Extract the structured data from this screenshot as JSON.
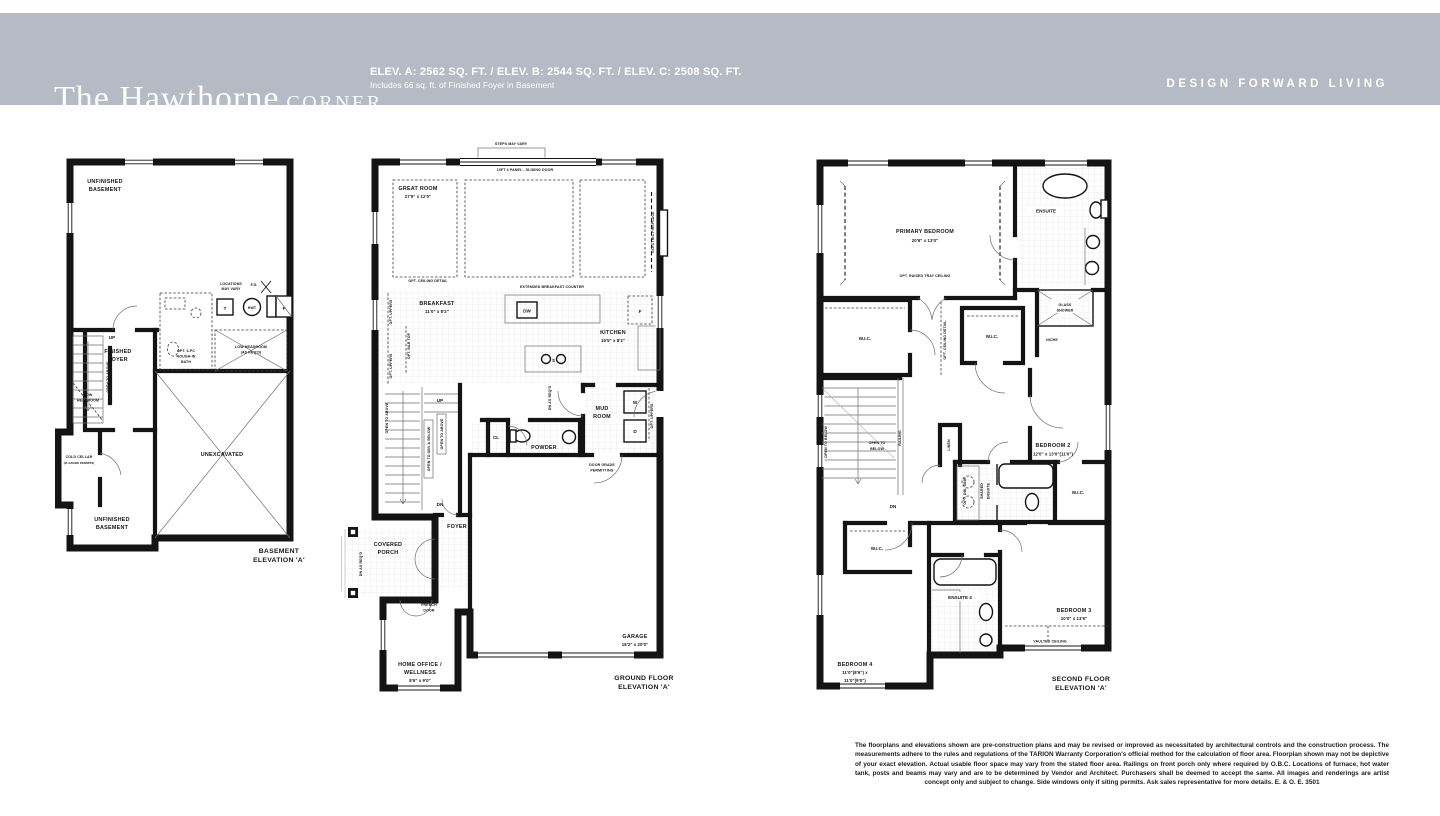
{
  "header": {
    "title": "The Hawthorne",
    "title_suffix": "CORNER",
    "elevations": "ELEV. A: 2562 SQ. FT. / ELEV. B: 2544 SQ. FT. / ELEV. C: 2508 SQ. FT.",
    "includes": "Includes 66 sq. ft. of Finished Foyer in Basement",
    "brand": "DESIGN FORWARD LIVING",
    "band_color": "#b6bac4"
  },
  "plans": {
    "basement": {
      "labels": {
        "unfin1a": "UNFINISHED",
        "unfin1b": "BASEMENT",
        "loc1": "LOCATIONS",
        "loc2": "MAY VARY",
        "fd": "F.D.",
        "t": "T",
        "hwt": "HWT",
        "f": "F",
        "up": "UP",
        "foy1": "FINISHED",
        "foy2": "FOYER",
        "bath1": "OPT. 3-PC",
        "bath2": "ROUGH-IN",
        "bath3": "BATH",
        "lh1": "LOW HEADROOM",
        "lh2": "(AS REQ'D)",
        "openabove": "OPEN TO ABOVE",
        "lh3": "LOW",
        "lh4": "HEADROOM",
        "cold1": "COLD CELLAR",
        "cold2": "(IF GRADE PERMITS)",
        "unex": "UNEXCAVATED",
        "unfin2a": "UNFINISHED",
        "unfin2b": "BASEMENT",
        "cap1": "BASEMENT",
        "cap2": "ELEVATION 'A'"
      }
    },
    "ground": {
      "labels": {
        "steps": "STEPS MAY VARY",
        "sliding": "10FT 4 PANEL -  SLIDING DOOR",
        "great1": "GREAT ROOM",
        "great2": "27'5\" x 12'0\"",
        "fireplace": "ELECTRIC FIREPLACE",
        "ceiling": "OPT. CEILING DETAIL",
        "counter": "EXTENDED BREAKFAST COUNTER",
        "dw": "DW",
        "brk1": "BREAKFAST",
        "brk2": "11'0\" x 8'2\"",
        "uppers": "OPT. UPPERS",
        "bartop": "OPT. BAR TOP",
        "kit1": "KITCHEN",
        "kit2": "15'5\" x 8'2\"",
        "f": "F",
        "s": "S",
        "up": "UP",
        "dn": "DN",
        "openabove": "OPEN TO ABOVE",
        "openabvbelow": "OPEN TO ABV & BELOW",
        "dnasreqd": "DN AS REQ'D",
        "cl": "CL",
        "powder": "POWDER",
        "mud1": "MUD",
        "mud2": "ROOM",
        "w": "W",
        "d": "D",
        "grade1": "DOOR GRADE",
        "grade2": "PERMITTING",
        "foyer": "FOYER",
        "porch1": "COVERED",
        "porch2": "PORCH",
        "fr1": "FRENCH",
        "fr2": "DOOR",
        "off1": "HOME OFFICE /",
        "off2": "WELLNESS",
        "off3": "8'6\" x 9'0\"",
        "gar1": "GARAGE",
        "gar2": "18'2\" x 20'0\"",
        "cap1": "GROUND FLOOR",
        "cap2": "ELEVATION 'A'"
      }
    },
    "second": {
      "labels": {
        "prim1": "PRIMARY BEDROOM",
        "prim2": "20'6\" x 13'0\"",
        "tray": "OPT. RAISED TRAY CEILING",
        "ens": "ENSUITE",
        "glass1": "GLASS",
        "glass2": "SHOWER",
        "wic": "W.I.C.",
        "niche": "NICHE",
        "optceil": "OPT. CEILING DETAIL",
        "opentobelow": "OPEN TO BELOW",
        "otb1": "OPEN TO",
        "otb2": "BELOW",
        "railing": "RAILING",
        "linen": "LINEN",
        "bed2a": "BEDROOM 2",
        "bed2b": "12'0\" x 13'0\"(11'0\")",
        "dn": "DN",
        "optdbl": "OPT. DBL SINK",
        "shared1": "SHARED",
        "shared2": "ENSUITE",
        "ens4": "ENSUITE 4",
        "bed3a": "BEDROOM 3",
        "bed3b": "10'0\" x 13'6\"",
        "vault": "VAULTED CEILING",
        "bed4a": "BEDROOM 4",
        "bed4b": "11'0\"(8'6\") x",
        "bed4c": "11'0\"(9'0\")",
        "cap1": "SECOND FLOOR",
        "cap2": "ELEVATION 'A'"
      }
    }
  },
  "disclaimer": "The floorplans and elevations shown are pre-construction plans and may be revised or improved as necessitated by architectural controls and the construction process. The measurements adhere to the rules and regulations of the TARION Warranty Corporation's official method for the calculation of floor area. Floorplan shown may not be depictive of your exact elevation. Actual usable floor space may vary from the stated floor area. Railings on front porch only where required by O.B.C. Locations of furnace, hot water tank, posts and beams may vary and are to be determined by Vendor and Architect. Purchasers shall be deemed to accept the same. All images and renderings are artist concept only and subject to change. Side windows only if siting permits. Ask sales representative for more details. E. & O. E. 3501"
}
